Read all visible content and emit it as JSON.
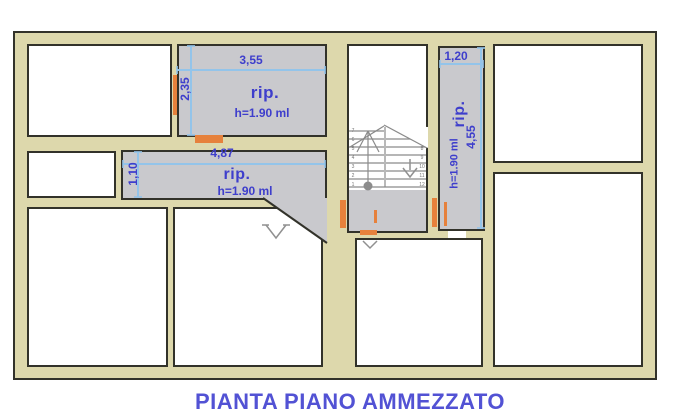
{
  "title": "PIANTA PIANO AMMEZZATO",
  "colors": {
    "wall_fill": "#ddd8ac",
    "wall_line": "#32322a",
    "room_fill": "#ffffff",
    "gray_fill": "#c9c9cd",
    "door_orange": "#e6813c",
    "dim_blue": "#93c4ea",
    "text_blue": "#3e3ecc",
    "title_blue": "#5252d4",
    "stair_line": "#8a8a8a",
    "stair_num": "#777777"
  },
  "rooms": {
    "storage_top": {
      "label": "rip.",
      "height_note": "h=1.90 ml",
      "width_dim": "3,55",
      "height_dim": "2,35"
    },
    "storage_corridor": {
      "label": "rip.",
      "height_note": "h=1.90 ml",
      "width_dim": "4,87",
      "height_dim": "1,10"
    },
    "storage_vertical": {
      "label": "rip.",
      "height_note": "h=1.90 ml",
      "width_dim": "1,20",
      "height_dim": "4,55"
    }
  },
  "stairs": {
    "steps": [
      "1",
      "2",
      "3",
      "4",
      "5",
      "6",
      "7",
      "8",
      "9",
      "10",
      "11",
      "12"
    ]
  }
}
